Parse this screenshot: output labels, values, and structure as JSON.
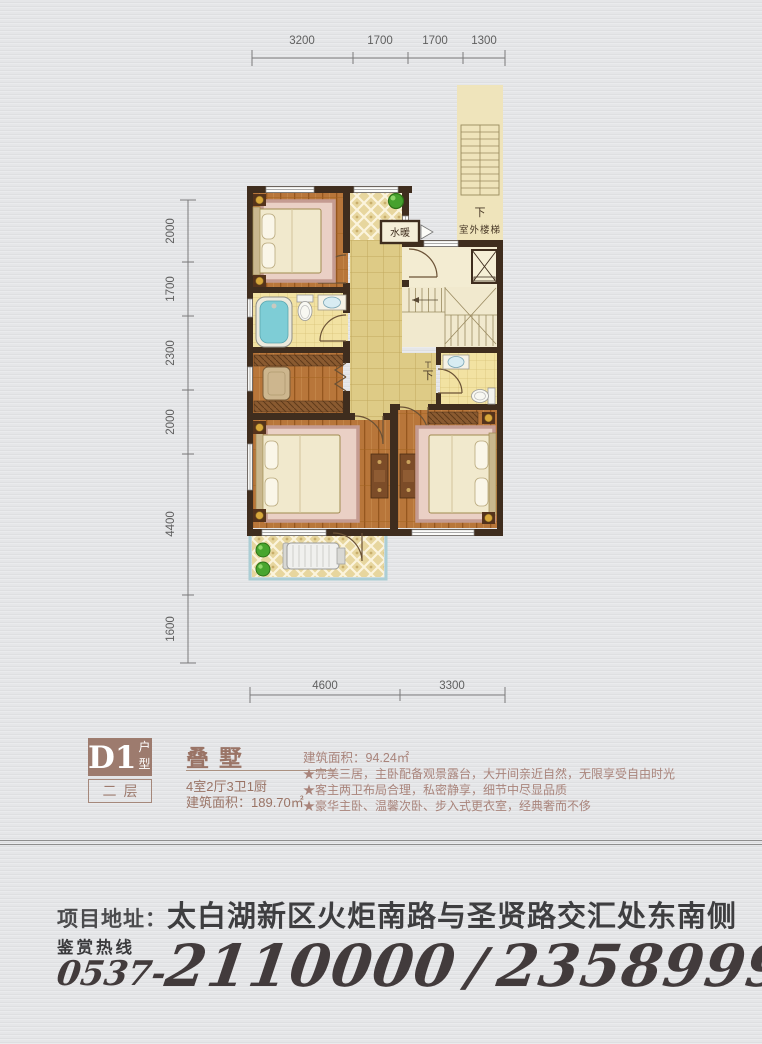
{
  "dimensions": {
    "top": [
      "3200",
      "1700",
      "1700",
      "1300"
    ],
    "left": [
      "2000",
      "1700",
      "2300",
      "2000",
      "4400",
      "1600"
    ],
    "bottom": [
      "4600",
      "3300"
    ]
  },
  "plan_labels": {
    "water_heating": "水暖",
    "outdoor_down": "下",
    "outdoor_stairs": "室外楼梯",
    "indoor_down": "下"
  },
  "info": {
    "unit_code": "D1",
    "unit_code_suffix": "户型",
    "floor_label": "二层",
    "product_type": "叠墅",
    "layout": "4室2厅3卫1厨",
    "total_area": "建筑面积：189.70㎡",
    "floor_area": "建筑面积：94.24㎡",
    "features": [
      "★完美三居，主卧配备观景露台，大开间亲近自然，无限享受自由时光",
      "★客主两卫布局合理，私密静享，细节中尽显品质",
      "★豪华主卧、温馨次卧、步入式更衣室，经典奢而不侈"
    ]
  },
  "footer": {
    "address_label": "项目地址：",
    "address": "太白湖新区火炬南路与圣贤路交汇处东南侧",
    "hotline_label": "鉴赏热线",
    "phone_area": "0537-",
    "phone_1": "2110000",
    "phone_sep": "/",
    "phone_2": "2358999"
  },
  "colors": {
    "accent_mauve": "#9d7b6e",
    "feature_text": "#a9847b",
    "wall": "#3f2d1e",
    "wood_floor": "#b8763a",
    "bath_tile": "#f2e2a2",
    "corridor_tile": "#decb86",
    "cream_floor": "#f3ecd2",
    "terrace_trim": "#abced5",
    "footer_text": "#3e3e40"
  }
}
